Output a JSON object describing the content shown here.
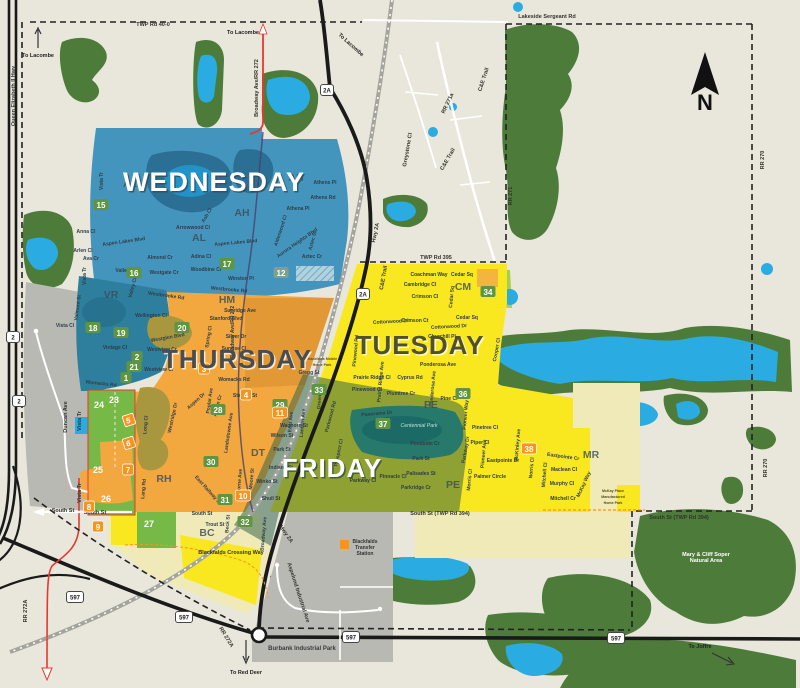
{
  "colors": {
    "bg": "#e9e7db",
    "forest": "#4d7c3a",
    "water": "#2aace2",
    "pond_dark": "#2b6f95",
    "wednesday": "#4495bd",
    "wednesday_dark": "#2e7f9d",
    "thursday": "#f2a73f",
    "thursday_dark": "#d8922f",
    "tuesday": "#f9e820",
    "pale_yellow": "#efeab8",
    "friday": "#2f5f47",
    "friday_teal": "#26796b",
    "green_zone": "#76b947",
    "gray": "#b9b9b3",
    "road": "#1a1a1a",
    "red": "#e8382e",
    "purple": "#4a3f6b",
    "rail": "#a4a49c",
    "boundary": "#222222",
    "orange_badge": "#f7941d",
    "green_badge": "#5e9442",
    "gray_badge": "#7f9f8f"
  },
  "compass": {
    "label": "N"
  },
  "days": [
    {
      "label": "WEDNESDAY",
      "x": 214,
      "y": 191,
      "fill": "#ffffff",
      "shadow": "#2e4a58",
      "size": 27
    },
    {
      "label": "THURSDAY",
      "x": 237,
      "y": 368,
      "fill": "#474d52",
      "shadow": "#ffffff",
      "size": 26
    },
    {
      "label": "TUESDAY",
      "x": 420,
      "y": 354,
      "fill": "#50502a",
      "shadow": "#ffffff",
      "size": 26
    },
    {
      "label": "FRIDAY",
      "x": 332,
      "y": 477,
      "fill": "#ffffff",
      "shadow": "#2c4a3a",
      "size": 26
    }
  ],
  "area_codes": [
    [
      "AL",
      130,
      187
    ],
    [
      "AH",
      296,
      181
    ],
    [
      "AH",
      242,
      216
    ],
    [
      "AL",
      199,
      241
    ],
    [
      "VR",
      111,
      298
    ],
    [
      "HM",
      227,
      303
    ],
    [
      "CM",
      463,
      290
    ],
    [
      "PE",
      431,
      408
    ],
    [
      "PE",
      453,
      488
    ],
    [
      "DT",
      258,
      456
    ],
    [
      "RH",
      164,
      482
    ],
    [
      "BC",
      207,
      536
    ],
    [
      "MR",
      591,
      458
    ]
  ],
  "badges_green": [
    [
      "15",
      101,
      205
    ],
    [
      "16",
      134,
      273
    ],
    [
      "17",
      227,
      264
    ],
    [
      "18",
      93,
      328
    ],
    [
      "19",
      121,
      333
    ],
    [
      "20",
      182,
      328
    ],
    [
      "2",
      137,
      357
    ],
    [
      "21",
      134,
      367
    ],
    [
      "1",
      126,
      378
    ],
    [
      "28",
      218,
      410
    ],
    [
      "29",
      280,
      405
    ],
    [
      "33",
      319,
      390
    ],
    [
      "30",
      211,
      462
    ],
    [
      "31",
      225,
      500
    ],
    [
      "32",
      245,
      522
    ],
    [
      "34",
      488,
      292
    ],
    [
      "36",
      463,
      394
    ],
    [
      "37",
      383,
      424
    ]
  ],
  "badges_plain": [
    [
      "23",
      114,
      400
    ],
    [
      "24",
      99,
      405
    ],
    [
      "25",
      98,
      470
    ],
    [
      "26",
      106,
      499
    ],
    [
      "27",
      149,
      524
    ]
  ],
  "badges_orange": [
    [
      "3",
      204,
      369
    ],
    [
      "4",
      246,
      395
    ],
    [
      "7",
      128,
      470
    ],
    [
      "8",
      89,
      507
    ],
    [
      "9",
      98,
      527
    ],
    [
      "10",
      243,
      496
    ],
    [
      "11",
      280,
      413
    ],
    [
      "38",
      529,
      449
    ]
  ],
  "badges_special": [
    [
      "5",
      129,
      420
    ],
    [
      "6",
      129,
      443
    ]
  ],
  "badge_gray": [
    "12",
    281,
    273
  ],
  "shields": [
    [
      "2",
      13,
      337
    ],
    [
      "2",
      19,
      401
    ],
    [
      "2A",
      327,
      90
    ],
    [
      "2A",
      363,
      294
    ],
    [
      "597",
      75,
      597
    ],
    [
      "597",
      184,
      617
    ],
    [
      "597",
      351,
      637
    ],
    [
      "597",
      616,
      638
    ]
  ],
  "streets": [
    [
      "Vista Tr",
      103,
      181,
      -90
    ],
    [
      "Anna Cl",
      86,
      233,
      0
    ],
    [
      "Aspen Lakes Blvd",
      124,
      243,
      -8
    ],
    [
      "Arlen Cl",
      83,
      252,
      0
    ],
    [
      "Ava Cr",
      91,
      260,
      0
    ],
    [
      "Vista Tr",
      86,
      276,
      -90
    ],
    [
      "Valley Cr",
      126,
      272,
      0
    ],
    [
      "Almond Cr",
      160,
      259,
      0
    ],
    [
      "Westgate Cr",
      164,
      274,
      0
    ],
    [
      "Valley Cl",
      134,
      288,
      -75
    ],
    [
      "Westbrooke Rd",
      166,
      297,
      8
    ],
    [
      "Adina Cl",
      201,
      258,
      0
    ],
    [
      "Woodbine Cl",
      206,
      271,
      0
    ],
    [
      "Arrowwood Cl",
      193,
      229,
      0
    ],
    [
      "Ash Cl",
      208,
      216,
      -60
    ],
    [
      "Aspen Lakes Blvd",
      236,
      244,
      -5
    ],
    [
      "Athens Pl",
      325,
      184,
      0
    ],
    [
      "Athens Rd",
      323,
      199,
      0
    ],
    [
      "Athena Pl",
      298,
      210,
      0
    ],
    [
      "Alderwood Cl",
      282,
      231,
      -72
    ],
    [
      "Aurora Heights Blvd",
      298,
      244,
      -35
    ],
    [
      "Aztec St",
      314,
      241,
      -75
    ],
    [
      "Aztec Cr",
      312,
      258,
      0
    ],
    [
      "Winston Pl",
      241,
      280,
      0
    ],
    [
      "Westbrooke Rd",
      229,
      291,
      5
    ],
    [
      "Valmont St",
      79,
      308,
      -82
    ],
    [
      "Vista Cl",
      65,
      327,
      0
    ],
    [
      "Vintage Cl",
      115,
      349,
      0
    ],
    [
      "Womacks Rd",
      101,
      385,
      6
    ],
    [
      "Broadway Ave/RR 272",
      234,
      332,
      -90
    ],
    [
      "Wellington Cl",
      151,
      317,
      0
    ],
    [
      "Westglen Blvd",
      168,
      339,
      -10
    ],
    [
      "Westview Cr",
      162,
      351,
      0
    ],
    [
      "Westview Cr",
      159,
      371,
      0
    ],
    [
      "Sunridge Ave",
      240,
      312,
      0
    ],
    [
      "Stanford Blvd",
      226,
      320,
      0
    ],
    [
      "Silver Dr",
      236,
      338,
      0
    ],
    [
      "Sunrise Cl",
      234,
      350,
      0
    ],
    [
      "Spring Cl",
      210,
      337,
      -80
    ],
    [
      "Womacks Rd",
      234,
      381,
      0
    ],
    [
      "Gregg St",
      309,
      374,
      0
    ],
    [
      "Aspen Dr",
      197,
      402,
      -42
    ],
    [
      "Poplar Ave",
      211,
      401,
      -82
    ],
    [
      "Aspen Cr",
      219,
      406,
      -75
    ],
    [
      "Stanley St",
      245,
      397,
      0
    ],
    [
      "Landsdowne Ave",
      230,
      433,
      -82
    ],
    [
      "Westridge Dr",
      174,
      418,
      -78
    ],
    [
      "Long Cl",
      147,
      425,
      -85
    ],
    [
      "Lang Rd",
      145,
      489,
      -85
    ],
    [
      "East Ave",
      292,
      422,
      -85
    ],
    [
      "Lantern Ave",
      304,
      423,
      -85
    ],
    [
      "Green Cl",
      321,
      399,
      -85
    ],
    [
      "Waghorn St",
      294,
      427,
      0
    ],
    [
      "Wilson St",
      282,
      437,
      0
    ],
    [
      "Park St",
      282,
      451,
      0
    ],
    [
      "Indiana St",
      281,
      469,
      0
    ],
    [
      "Winko St",
      267,
      483,
      0
    ],
    [
      "Shull St",
      271,
      500,
      0
    ],
    [
      "Moore St",
      253,
      479,
      -85
    ],
    [
      "Lorne Ave",
      241,
      481,
      -85
    ],
    [
      "East Railway St",
      207,
      491,
      48
    ],
    [
      "Broadway Ave",
      265,
      534,
      -85
    ],
    [
      "South St",
      202,
      515,
      0
    ],
    [
      "Trout St",
      215,
      526,
      0
    ],
    [
      "Beck St",
      229,
      524,
      -85
    ],
    [
      "Parkwood Rd",
      332,
      417,
      -75
    ],
    [
      "Panorama Dr",
      377,
      415,
      -5
    ],
    [
      "Pondside Cr",
      425,
      445,
      0
    ],
    [
      "Park St",
      421,
      460,
      0
    ],
    [
      "Palisades St",
      421,
      475,
      0
    ],
    [
      "Parkridge Cr",
      416,
      489,
      0
    ],
    [
      "Pinnacle Cl",
      393,
      478,
      0
    ],
    [
      "Parkway Cl",
      363,
      482,
      0
    ],
    [
      "Prospect Cl",
      340,
      453,
      -78
    ],
    [
      "Pioneer Way",
      467,
      415,
      -85
    ],
    [
      "Coachman Way",
      429,
      276,
      0
    ],
    [
      "Cedar Sq",
      462,
      276,
      0
    ],
    [
      "Cambridge Cl",
      420,
      286,
      0
    ],
    [
      "Crimson Cl",
      425,
      298,
      0
    ],
    [
      "Cedar Sq",
      453,
      297,
      -85
    ],
    [
      "Cedar Sq",
      467,
      319,
      0
    ],
    [
      "Crimson Ct",
      415,
      322,
      0
    ],
    [
      "Cottonwood Dr",
      391,
      323,
      -3
    ],
    [
      "Cottonwood Dr",
      449,
      328,
      -3
    ],
    [
      "Churchill Pl",
      442,
      338,
      0
    ],
    [
      "Cooper Cl",
      498,
      350,
      -80
    ],
    [
      "Ponderosa Ave",
      438,
      366,
      0
    ],
    [
      "Ponderosa Ave",
      434,
      389,
      -85
    ],
    [
      "Cyprus Rd",
      410,
      379,
      0
    ],
    [
      "Prairie Ridge Ave",
      382,
      382,
      -85
    ],
    [
      "Prairie Ridge Cl",
      372,
      379,
      0
    ],
    [
      "Pinewood Rd",
      357,
      351,
      -85
    ],
    [
      "Pinewood Cl",
      367,
      391,
      0
    ],
    [
      "Plumtree Cr",
      401,
      395,
      0
    ],
    [
      "Pine Cl",
      449,
      400,
      0
    ],
    [
      "Pinetree Cl",
      485,
      429,
      0
    ],
    [
      "Piper Cl",
      480,
      444,
      0
    ],
    [
      "Parkway Dr",
      467,
      450,
      -80
    ],
    [
      "Pioneer Ave",
      485,
      454,
      -85
    ],
    [
      "Eastpointe Dr",
      503,
      462,
      0
    ],
    [
      "Palmer Circle",
      490,
      478,
      0
    ],
    [
      "McKinley Ave",
      519,
      445,
      -85
    ],
    [
      "Morris Cl",
      471,
      480,
      -85
    ],
    [
      "Norris Cl",
      533,
      468,
      -85
    ],
    [
      "Eastpointe Cr",
      563,
      458,
      8
    ],
    [
      "Maclean Cl",
      564,
      471,
      0
    ],
    [
      "Murphy Cl",
      562,
      485,
      0
    ],
    [
      "Mitchell Cr",
      563,
      500,
      0
    ],
    [
      "Mitchell Cl",
      546,
      475,
      -85
    ],
    [
      "McKay Way",
      585,
      485,
      -65
    ]
  ],
  "road_labels": [
    [
      "TWP Rd 40-0",
      153,
      26,
      0
    ],
    [
      "Lakeside Sergeant Rd",
      547,
      18,
      0
    ],
    [
      "Broadway Ave/RR 272",
      258,
      88,
      -90
    ],
    [
      "RR 271a",
      449,
      104,
      -65
    ],
    [
      "Greystone Cl",
      409,
      150,
      -80
    ],
    [
      "C&E Trail",
      485,
      80,
      -72
    ],
    [
      "C&E Trail",
      449,
      160,
      -60
    ],
    [
      "C&E Trail",
      385,
      278,
      -80
    ],
    [
      "RR 271",
      512,
      196,
      -90
    ],
    [
      "RR 270",
      764,
      160,
      -90
    ],
    [
      "RR 270",
      767,
      468,
      -90
    ],
    [
      "TWP Rd 395",
      436,
      259,
      0
    ],
    [
      "Hwy 2A",
      377,
      233,
      -78
    ],
    [
      "Hwy 2A",
      285,
      535,
      55
    ],
    [
      "Queen Elizabeth II Hwy",
      15,
      96,
      -90
    ],
    [
      "Duncan Ave",
      67,
      417,
      -90
    ],
    [
      "Vista Tr",
      81,
      421,
      -90
    ],
    [
      "Vista Tr",
      81,
      493,
      -90
    ],
    [
      "RR 272A",
      27,
      611,
      -90
    ],
    [
      "RR 272A",
      225,
      638,
      58
    ],
    [
      "South St",
      63,
      512,
      0
    ],
    [
      "South St",
      95,
      514,
      0
    ],
    [
      "South St (TWP Rd 394)",
      440,
      515,
      0
    ],
    [
      "South St (TWP Rd 394)",
      679,
      519,
      0
    ],
    [
      "Blackfalds Crossing Way",
      231,
      554,
      0
    ],
    [
      "Aspelund Industrial Ave",
      297,
      593,
      72
    ]
  ],
  "directions": [
    [
      "To Lacombe",
      38,
      57,
      0
    ],
    [
      "To Lacombe",
      243,
      34,
      0
    ],
    [
      "To Lacombe",
      350,
      46,
      42
    ],
    [
      "To Red Deer",
      246,
      674,
      0
    ],
    [
      "To Joffre",
      700,
      648,
      0
    ]
  ],
  "landmarks": {
    "transfer_station": [
      "Blackfalds",
      "Transfer",
      "Station"
    ],
    "mary_cliff": [
      "Mary & Cliff Soper",
      "Natural Area"
    ],
    "mckay": [
      "McKay Place",
      "Manufactured",
      "Home Park"
    ],
    "mobile_home": [
      "Blackfalds Mobile",
      "Home Park"
    ],
    "centennial": "Centennial Park",
    "burbank": "Burbank Industrial Park"
  }
}
